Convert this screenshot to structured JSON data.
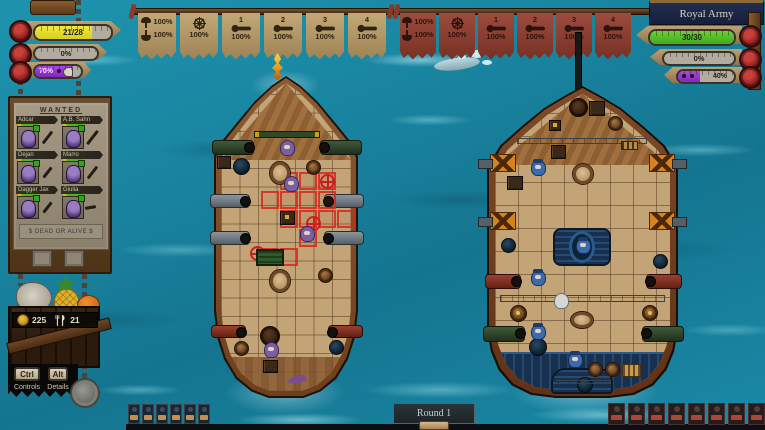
{
  "player_status": {
    "crew_bar": "21/28",
    "sails_bar": "0%",
    "loot_bar": "70%"
  },
  "enemy_status": {
    "name": "Royal Army",
    "health_bar": "30/30",
    "sails_bar": "0%",
    "loot_bar": "40%"
  },
  "player_stations": {
    "sails": {
      "up_pct": "100%",
      "down_pct": "100%"
    },
    "wheel": {
      "pct": "100%"
    },
    "cannons": [
      {
        "num": "1",
        "pct": "100%"
      },
      {
        "num": "2",
        "pct": "100%"
      },
      {
        "num": "3",
        "pct": "100%"
      },
      {
        "num": "4",
        "pct": "100%"
      }
    ]
  },
  "enemy_stations": {
    "sails": {
      "up_pct": "100%",
      "down_pct": "100%"
    },
    "wheel": {
      "pct": "100%"
    },
    "cannons": [
      {
        "num": "1",
        "pct": "100%"
      },
      {
        "num": "2",
        "pct": "100%"
      },
      {
        "num": "3",
        "pct": "100%"
      },
      {
        "num": "4",
        "pct": "100%"
      }
    ]
  },
  "wanted_poster": {
    "title": "WANTED",
    "footer": "$ DEAD OR ALIVE $",
    "crew": [
      {
        "name": "Adcar"
      },
      {
        "name": "A.B. Sahn"
      },
      {
        "name": "Dejan"
      },
      {
        "name": "Marro"
      },
      {
        "name": "Dagger Jax"
      },
      {
        "name": "Giulia"
      }
    ]
  },
  "resources": {
    "gold": "225",
    "food": "21"
  },
  "hotkeys": {
    "controls": {
      "key": "Ctrl",
      "label": "Controls"
    },
    "details": {
      "key": "Alt",
      "label": "Details"
    }
  },
  "round_banner": "Round 1",
  "icons": {
    "sail": "dome-sail-shape",
    "wheel": "ship-wheel",
    "cannon": "cannon-with-wheel",
    "gold": "coin-circle",
    "food": "fork-and-knife"
  },
  "colors": {
    "ocean": "#1a8aa6",
    "player_flag_tan": "#bca273",
    "enemy_flag_red": "#93463a",
    "health_green": "#55c629",
    "crew_yellow": "#e6df39",
    "loot_purple": "#9b2fd2",
    "enemy_sign_navy": "#1c2642"
  }
}
